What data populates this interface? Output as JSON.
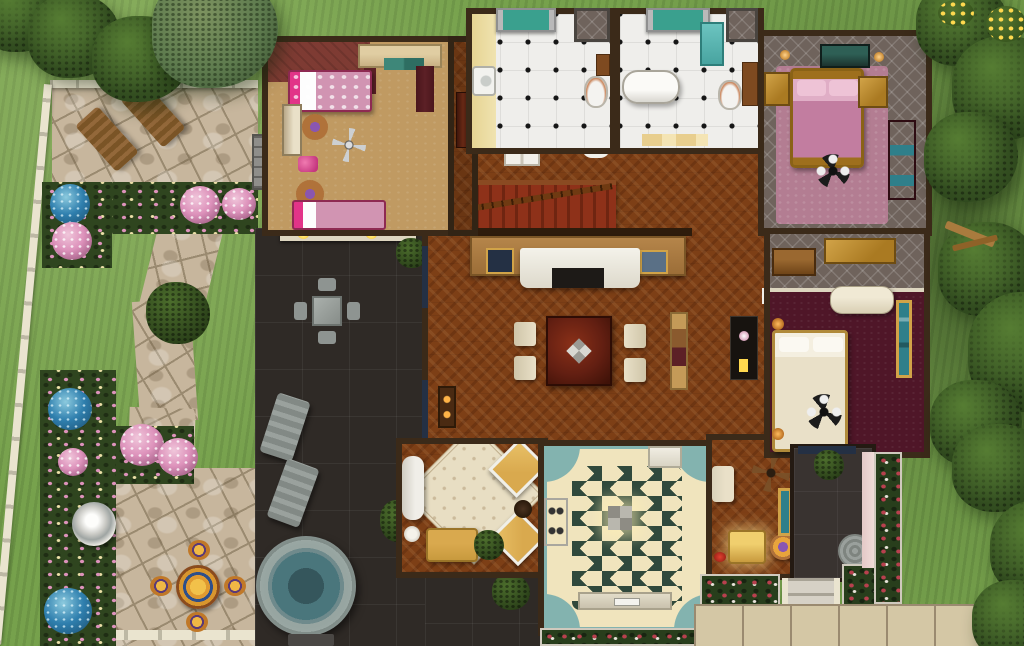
{
  "scene": {
    "view": "top-down-house-lot",
    "style": "isometric-game-screenshot"
  },
  "names": {
    "lot": "sims-house-lot",
    "garden": "left-garden",
    "stonePatio": "stone-patio",
    "stonePath": "stone-path",
    "lawn": "lawn",
    "fountain": "garden-fountain",
    "mosaicSet": "mosaic-table-set",
    "darkPatio": "dark-tile-patio",
    "hotTub": "hot-tub",
    "kidsBedroom": "kids-bedroom",
    "bathroom1": "bathroom-with-sink",
    "bathroom2": "bathroom-with-tub",
    "bedroomPink": "pink-master-bedroom",
    "bedroomMaster": "maroon-bedroom",
    "livingRoom": "living-room",
    "diningArea": "dining-area",
    "kitchen": "kitchen",
    "sunroom": "sitting-nook",
    "entry": "entry-hall",
    "porch": "back-porch",
    "steps": "porch-steps",
    "sidewalk": "sidewalk",
    "trees": "trees"
  },
  "colors": {
    "grassBase": "#76a14c",
    "treeGreen": "#3f5e28",
    "treeDark": "#2b431b",
    "treeLight": "#567d33",
    "conifer": "#5e7b4e",
    "stone": "#c7b69d",
    "stoneLight": "#d9cab3",
    "stoneLine": "#9a8a70",
    "fence": "#eae4cf",
    "bedGreen": "#2f451f",
    "flowerPink": "#dd92bb",
    "flowerBlue": "#2f7fae",
    "flowerCream": "#ece0a8",
    "roseRed": "#b8404e",
    "darkPatio": "#2f2a26",
    "wallDark": "#3b2a19",
    "wallCream": "#ddd5bf",
    "woodFloor": "#7d3f16",
    "kidsFloor": "#c09a62",
    "kidsRug": "#7e3b33",
    "maroon": "#5c2026",
    "tileWhite": "#efeeeb",
    "quilt": "#6f635c",
    "mauveRug": "#b37d92",
    "pinkBlanket": "#d194b2",
    "hotPink": "#e23488",
    "gold": "#aa7a22",
    "goldLight": "#d1a348",
    "maroonCarpet": "#4f1628",
    "cream": "#e9e0c8",
    "kitchenCream": "#f0e4bd",
    "kitchenGreen": "#30493c",
    "kitchenTeal": "#83b3af",
    "stairRed": "#8e3119",
    "counterTan": "#b5854a",
    "navy": "#243044",
    "mahoganyTable": "#631f12",
    "rugCream": "#e8dec3",
    "armGold": "#d9a94e",
    "hotTubWater": "#4a767c",
    "hotTubRim": "#97a5a1",
    "loungerGray": "#8e9491",
    "porchTile": "#393330",
    "stepGray": "#cdc8bb",
    "sidewalk": "#d4c7a5",
    "doorWhite": "#f1efe9",
    "lampYellow": "#ffd94f",
    "tealArt": "#2f7f8a",
    "tealGlass": "#3aa08e",
    "aqua": "#6cc4c0",
    "purpleLamp": "#8a56b0",
    "orangeWood": "#b0723a",
    "chimGray": "#8f8e8a"
  },
  "rooms": [
    {
      "id": "kids-bedroom",
      "floor": "tan-carpet",
      "furniture": [
        "single-bed-pink",
        "single-bed-pink",
        "loveseat-teal-cushions",
        "cream-dresser",
        "round-table-purple-lamp",
        "round-table-purple-lamp",
        "ceiling-fan",
        "pink-toy",
        "maroon-curtains"
      ]
    },
    {
      "id": "bathroom-1",
      "floor": "white-tile-black-diamonds",
      "furniture": [
        "sink",
        "toilet",
        "cabinet",
        "window-teal-curtains",
        "linen-closet"
      ]
    },
    {
      "id": "bathroom-2",
      "floor": "white-tile-black-diamonds",
      "furniture": [
        "clawfoot-bathtub",
        "toilet",
        "shower-stall",
        "cabinet",
        "window-teal-curtains",
        "linen-closet"
      ]
    },
    {
      "id": "pink-bedroom",
      "floor": "gray-quilt-and-mauve-rug",
      "furniture": [
        "gold-double-bed-pink-bedding",
        "nightstand",
        "nightstand",
        "foot-bench",
        "maroon-dresser",
        "wall-candles",
        "ceiling-lamp"
      ]
    },
    {
      "id": "maroon-bedroom",
      "floor": "maroon-carpet",
      "furniture": [
        "cream-double-bed",
        "gold-dresser",
        "brown-dresser",
        "cream-chaise",
        "teal-painting",
        "wall-lamps",
        "ceiling-fan"
      ]
    },
    {
      "id": "living-room",
      "floor": "herringbone-wood",
      "furniture": [
        "staircase",
        "white-door",
        "console-table",
        "white-sofa",
        "coffee-table",
        "navy-end-tables",
        "dining-table-mahogany",
        "dining-chairs-x4",
        "display-shelf",
        "black-desk",
        "fireplace",
        "windows"
      ]
    },
    {
      "id": "sitting-nook",
      "floor": "herringbone-wood",
      "furniture": [
        "cream-rug",
        "white-chaise",
        "candle-table",
        "gold-armchair",
        "gold-armchair",
        "gold-sofa",
        "potted-plant",
        "round-table"
      ]
    },
    {
      "id": "kitchen",
      "floor": "green-white-diamond-checker",
      "furniture": [
        "stove",
        "counter-with-sink",
        "corner-counter",
        "ceiling-lamp"
      ]
    },
    {
      "id": "entry-hall",
      "floor": "herringbone-wood",
      "furniture": [
        "ceiling-fan",
        "yellow-armchair",
        "orange-table-purple-flowers",
        "cream-loveseat",
        "mirror",
        "red-bowl"
      ]
    }
  ],
  "outdoor": {
    "garden": [
      "white-fence",
      "stone-patio",
      "wooden-loungers-x2",
      "flower-beds",
      "pink-bushes",
      "blue-bushes",
      "round-hedge",
      "stone-path",
      "fountain",
      "mosaic-table-with-4-stools",
      "tree-bench"
    ],
    "darkPatio": [
      "gray-dining-set",
      "gray-loungers-x2",
      "hot-tub",
      "potted-ferns",
      "wall-lamps",
      "chimney"
    ],
    "rightYard": [
      "back-porch",
      "round-rug",
      "topiary",
      "steps",
      "rose-beds",
      "sidewalk",
      "trees",
      "yellow-flower-shrubs",
      "wood-debris"
    ]
  }
}
